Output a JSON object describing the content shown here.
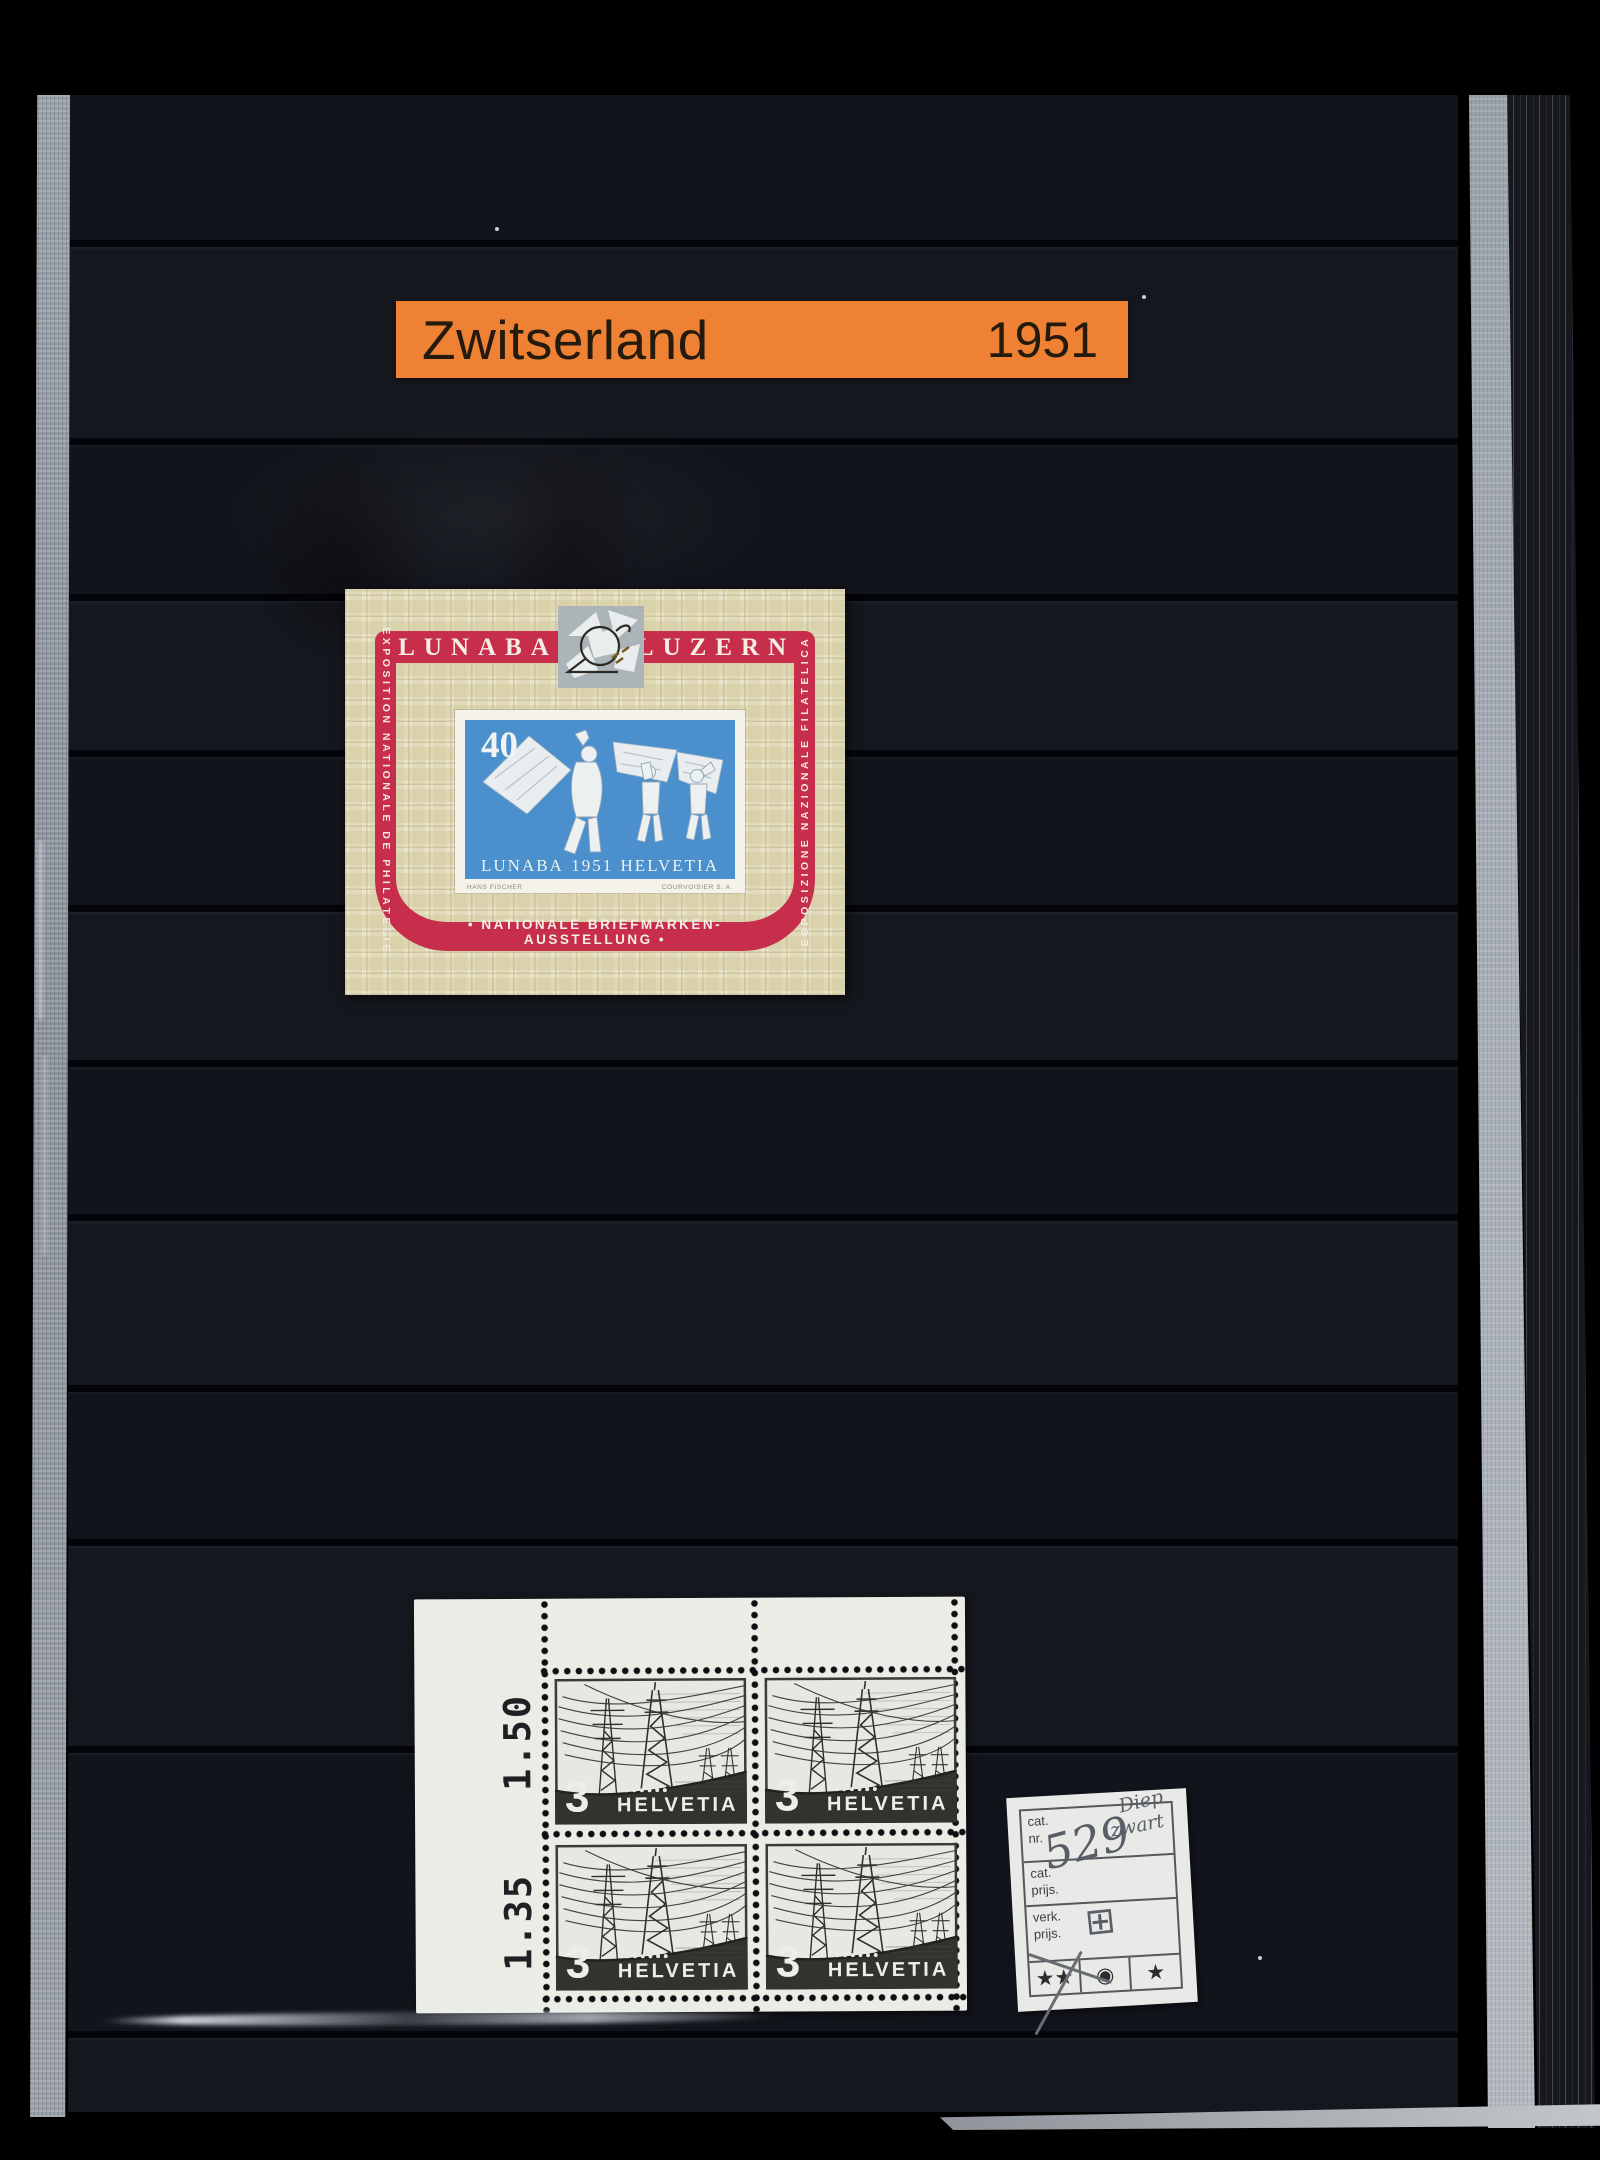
{
  "album_label": {
    "country": "Zwitserland",
    "year": "1951"
  },
  "sheet": {
    "title_left": "LUNABA",
    "title_right": "LUZERN",
    "side_left": "EXPOSITION NATIONALE DE PHILATELIE",
    "side_right": "ESPOSIZIONE NAZIONALE FILATELICA",
    "bottom_text": "•   NATIONALE BRIEFMARKEN-AUSSTELLUNG   •",
    "stamp_value": "40",
    "caption_left": "LUNABA",
    "caption_year": "1951",
    "caption_right": "HELVETIA",
    "designer": "HANS FISCHER",
    "printer": "COURVOISIER S. A."
  },
  "block": {
    "plate_value_top": "1.50",
    "plate_value_bottom": "1.35",
    "denomination": "3",
    "country": "HELVETIA"
  },
  "card": {
    "row1": {
      "label_line1": "cat.",
      "label_line2": "nr.",
      "value": "529",
      "note_line1": "Diep",
      "note_line2": "zwart"
    },
    "row2": {
      "label_line1": "cat.",
      "label_line2": "prijs."
    },
    "row3": {
      "label_line1": "verk.",
      "label_line2": "prijs.",
      "value": "⊞"
    },
    "grades": {
      "mnh": "★★",
      "used": "◉",
      "hinged": "★"
    }
  },
  "colors": {
    "label_orange": "#ee8133",
    "ribbon_red": "#c62e4b",
    "stamp_blue": "#4b90cc",
    "sheet_cream": "#eae4ca",
    "page_black": "#101218",
    "block_paper": "#eaede5",
    "ink_charcoal": "#2f322e"
  }
}
